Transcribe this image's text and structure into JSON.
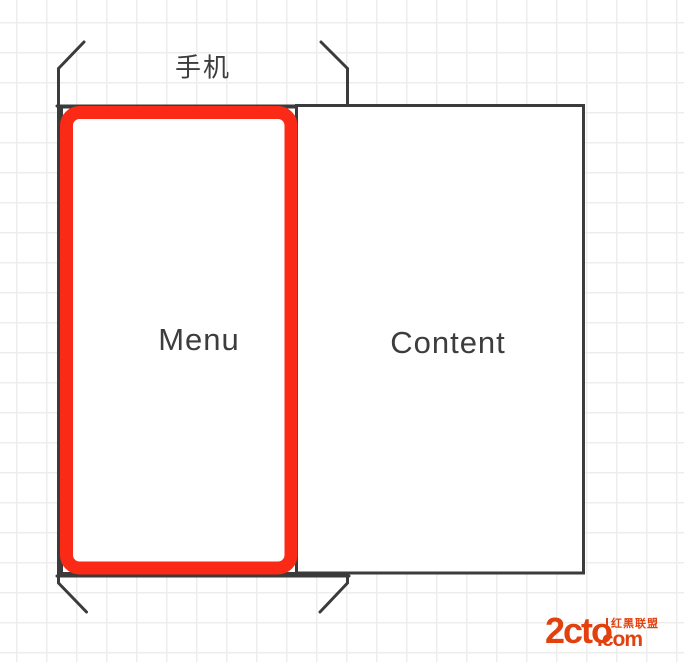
{
  "canvas": {
    "background": "#ffffff",
    "grid_color": "#ededed",
    "grid_size_px": 30
  },
  "shapes": {
    "phone": {
      "label": "手机",
      "stroke": "#3b3b3b"
    },
    "menu": {
      "label": "Menu",
      "stroke": "#3b3b3b",
      "fill": "#ffffff"
    },
    "content": {
      "label": "Content",
      "stroke": "#3b3b3b",
      "fill": "#ffffff"
    },
    "selection": {
      "color": "#fa2a16"
    }
  },
  "text_color": "#3d3d3d",
  "watermark": {
    "brand": "2cto",
    "domain_suffix": ".com",
    "tagline": "红黑联盟",
    "color": "#e2410e"
  }
}
